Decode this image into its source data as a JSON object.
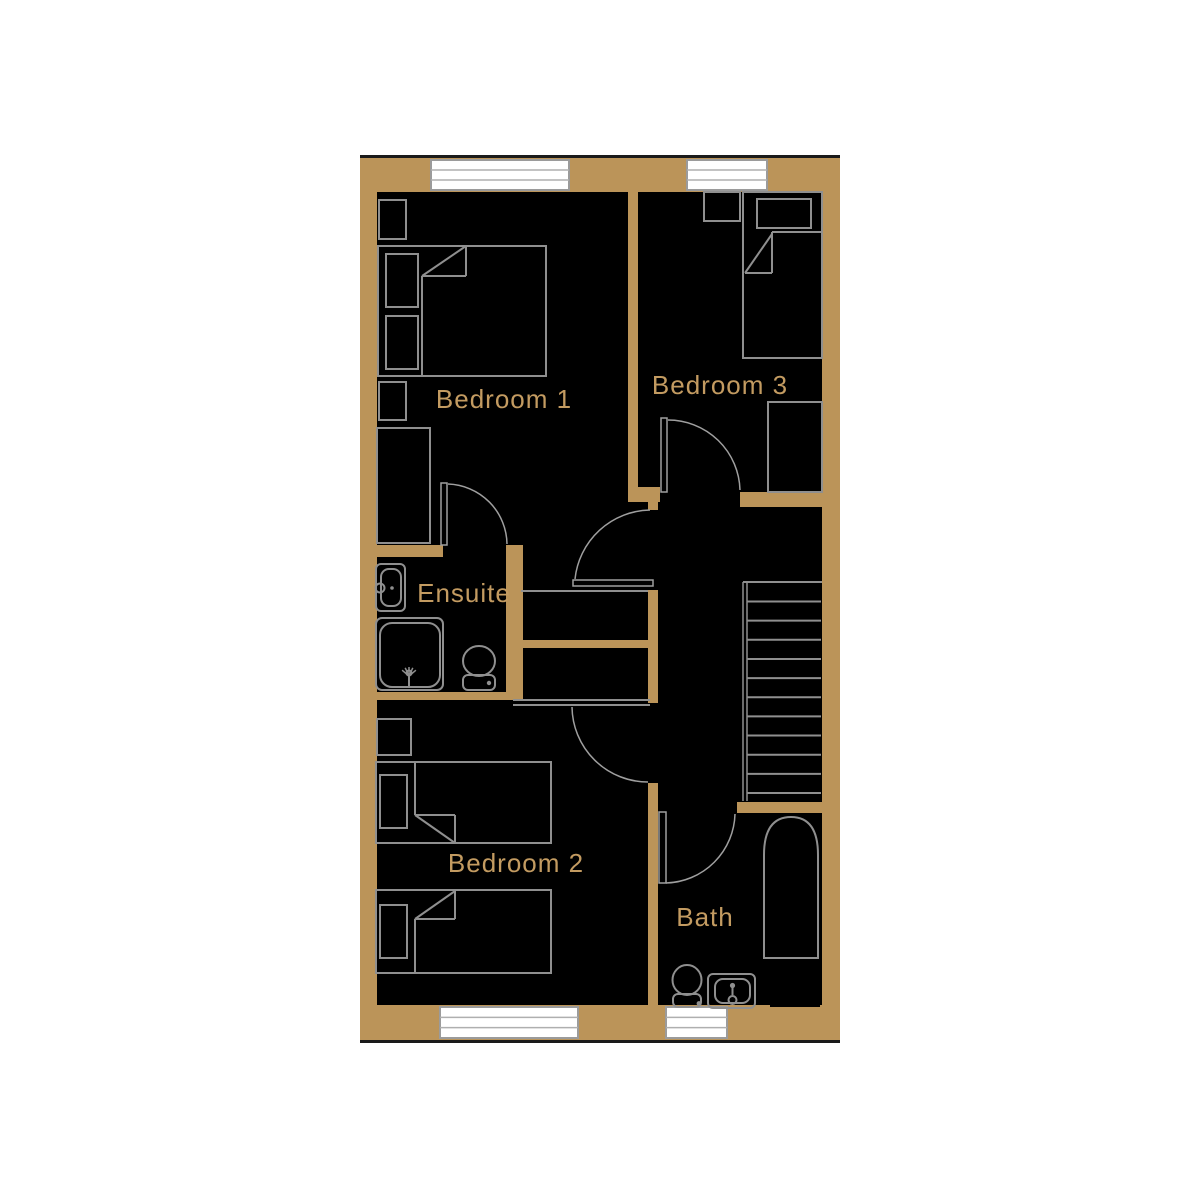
{
  "colors": {
    "background": "#ffffff",
    "floor": "#000000",
    "wall": "#bb9459",
    "label": "#c39b61",
    "furniture": "#8f8f8f",
    "door": "#9f9f9f",
    "window_border": "#9b9b9b",
    "window_slat": "#afafaf",
    "window_fill": "#ffffff",
    "exterior_line": "#1a1a1a"
  },
  "rooms": [
    {
      "id": "bedroom1",
      "label": "Bedroom 1",
      "x": 504,
      "y": 408
    },
    {
      "id": "bedroom3",
      "label": "Bedroom 3",
      "x": 720,
      "y": 394
    },
    {
      "id": "ensuite",
      "label": "Ensuite",
      "x": 464,
      "y": 602
    },
    {
      "id": "bedroom2",
      "label": "Bedroom 2",
      "x": 516,
      "y": 872
    },
    {
      "id": "bath",
      "label": "Bath",
      "x": 705,
      "y": 926
    }
  ],
  "geometry": {
    "plan_rect": [
      360,
      155,
      480,
      888
    ],
    "exterior_lines": [
      [
        360,
        156.5,
        840,
        156.5
      ],
      [
        360,
        1041.5,
        840,
        1041.5
      ]
    ],
    "walls": [
      {
        "n": "outer-wall-top",
        "r": [
          360,
          157,
          480,
          35
        ]
      },
      {
        "n": "outer-wall-left",
        "r": [
          360,
          157,
          17,
          883
        ]
      },
      {
        "n": "outer-wall-right",
        "r": [
          822,
          157,
          18,
          883
        ]
      },
      {
        "n": "outer-wall-bottom",
        "r": [
          360,
          1005,
          480,
          35
        ]
      },
      {
        "n": "wall-bed1-bed3-divider",
        "r": [
          628,
          161,
          10,
          331
        ]
      },
      {
        "n": "wall-divider-foot",
        "r": [
          628,
          487,
          32,
          15
        ]
      },
      {
        "n": "wall-divider-stub",
        "r": [
          648,
          502,
          10,
          8
        ]
      },
      {
        "n": "wall-bed3-bottom",
        "r": [
          740,
          492,
          82,
          15
        ]
      },
      {
        "n": "wall-ensuite-top",
        "r": [
          360,
          545,
          83,
          12
        ]
      },
      {
        "n": "wall-ensuite-right",
        "r": [
          506,
          545,
          17,
          155
        ]
      },
      {
        "n": "wall-ensuite-bottom",
        "r": [
          360,
          692,
          146,
          8
        ]
      },
      {
        "n": "wall-cupboard-mid",
        "r": [
          511,
          640,
          144,
          8
        ]
      },
      {
        "n": "wall-landing-west",
        "r": [
          648,
          590,
          10,
          113
        ]
      },
      {
        "n": "wall-bed2-bath-divider",
        "r": [
          648,
          783,
          10,
          222
        ]
      },
      {
        "n": "wall-bath-top",
        "r": [
          737,
          802,
          103,
          11
        ]
      }
    ],
    "windows": [
      {
        "n": "window-top-bedroom1",
        "r": [
          431,
          160,
          138,
          30
        ]
      },
      {
        "n": "window-top-bedroom3",
        "r": [
          687,
          160,
          80,
          30
        ]
      },
      {
        "n": "window-bottom-bedroom2",
        "r": [
          440,
          1007,
          138,
          31
        ]
      },
      {
        "n": "window-bottom-bath",
        "r": [
          666,
          1007,
          61,
          31
        ]
      }
    ],
    "thin_lines": [
      {
        "n": "cupboard-front-line",
        "l": [
          521,
          591,
          648,
          591
        ]
      },
      {
        "n": "bedroom2-door-head-line",
        "l": [
          513,
          700,
          650,
          700
        ]
      },
      {
        "n": "bedroom2-door-head-line",
        "l": [
          513,
          705,
          650,
          705
        ]
      }
    ],
    "stairs": {
      "top_line": [
        743,
        582,
        822,
        582
      ],
      "left_lines_x": [
        743,
        747
      ],
      "y_top": 582,
      "y_bottom": 801,
      "tread_x": [
        747,
        821
      ],
      "tread_y0": 601.5,
      "tread_step": 19.15,
      "tread_count": 11
    },
    "furniture_rects": [
      {
        "n": "bedroom1-bedside-top",
        "r": [
          379,
          200,
          27,
          39
        ]
      },
      {
        "n": "bedroom1-double-bed",
        "r": [
          378,
          246,
          168,
          130
        ]
      },
      {
        "n": "bedroom1-pillow-1",
        "r": [
          386,
          254,
          32,
          53
        ]
      },
      {
        "n": "bedroom1-pillow-2",
        "r": [
          386,
          316,
          32,
          53
        ]
      },
      {
        "n": "bedroom1-bedside-bottom",
        "r": [
          379,
          382,
          27,
          38
        ]
      },
      {
        "n": "bedroom1-wardrobe",
        "r": [
          377,
          428,
          53,
          115
        ]
      },
      {
        "n": "bedroom3-bedside",
        "r": [
          704,
          192,
          36,
          29
        ]
      },
      {
        "n": "bedroom3-single-bed",
        "r": [
          743,
          192,
          79,
          166
        ]
      },
      {
        "n": "bedroom3-pillow",
        "r": [
          757,
          199,
          54,
          29
        ]
      },
      {
        "n": "bedroom3-wardrobe",
        "r": [
          768,
          402,
          54,
          90
        ]
      },
      {
        "n": "bedroom2-cabinet",
        "r": [
          377,
          719,
          34,
          36
        ]
      },
      {
        "n": "bedroom2-bed-a",
        "r": [
          376,
          762,
          175,
          81
        ]
      },
      {
        "n": "bedroom2-pillow-a",
        "r": [
          380,
          775,
          27,
          53
        ]
      },
      {
        "n": "bedroom2-bed-b",
        "r": [
          376,
          890,
          175,
          83
        ]
      },
      {
        "n": "bedroom2-pillow-b",
        "r": [
          380,
          905,
          27,
          53
        ]
      }
    ],
    "furniture_lines": [
      {
        "n": "bedroom1-duvet-edge",
        "l": [
          422,
          276,
          422,
          376
        ]
      },
      {
        "n": "bedroom1-duvet-fold",
        "l": [
          422,
          276,
          466,
          246
        ]
      },
      {
        "n": "bedroom1-duvet-fold",
        "l": [
          466,
          246,
          466,
          276
        ]
      },
      {
        "n": "bedroom1-duvet-fold",
        "l": [
          422,
          276,
          466,
          276
        ]
      },
      {
        "n": "bedroom3-duvet-edge",
        "l": [
          772,
          232,
          822,
          232
        ]
      },
      {
        "n": "bedroom3-duvet-fold",
        "l": [
          745,
          273,
          772,
          234
        ]
      },
      {
        "n": "bedroom3-duvet-fold",
        "l": [
          772,
          232,
          772,
          273
        ]
      },
      {
        "n": "bedroom3-duvet-fold",
        "l": [
          745,
          273,
          772,
          273
        ]
      },
      {
        "n": "bedroom2-bed-a-duvet-edge",
        "l": [
          415,
          762,
          415,
          815
        ]
      },
      {
        "n": "bedroom2-bed-a-fold",
        "l": [
          415,
          815,
          455,
          843
        ]
      },
      {
        "n": "bedroom2-bed-a-fold",
        "l": [
          415,
          815,
          455,
          815
        ]
      },
      {
        "n": "bedroom2-bed-a-fold",
        "l": [
          455,
          815,
          455,
          843
        ]
      },
      {
        "n": "bedroom2-bed-b-duvet-edge",
        "l": [
          415,
          919,
          415,
          973
        ]
      },
      {
        "n": "bedroom2-bed-b-fold",
        "l": [
          415,
          919,
          455,
          891
        ]
      },
      {
        "n": "bedroom2-bed-b-fold",
        "l": [
          415,
          919,
          455,
          919
        ]
      },
      {
        "n": "bedroom2-bed-b-fold",
        "l": [
          455,
          891,
          455,
          919
        ]
      }
    ],
    "rounded_rects": [
      {
        "n": "ensuite-shower-tray",
        "r": [
          376,
          618,
          67,
          72
        ],
        "rx": 6
      },
      {
        "n": "ensuite-shower-tray-inner",
        "r": [
          380,
          623,
          60,
          64
        ],
        "rx": 12
      },
      {
        "n": "ensuite-basin",
        "r": [
          376,
          564,
          29,
          47
        ],
        "rx": 5
      },
      {
        "n": "ensuite-basin-inner",
        "r": [
          381,
          569,
          20,
          37
        ],
        "rx": 8
      },
      {
        "n": "ensuite-toilet-cistern",
        "r": [
          463,
          675,
          32,
          15
        ],
        "rx": 5
      },
      {
        "n": "bath-sink",
        "r": [
          708,
          974,
          47,
          34
        ],
        "rx": 5
      },
      {
        "n": "bath-sink-inner",
        "r": [
          715,
          979,
          35,
          24
        ],
        "rx": 8
      },
      {
        "n": "bath-toilet-cistern",
        "r": [
          673,
          994,
          28,
          13
        ],
        "rx": 5
      }
    ],
    "ellipses": [
      {
        "n": "ensuite-toilet-bowl",
        "e": [
          479,
          661,
          16,
          15
        ]
      },
      {
        "n": "bath-toilet-bowl",
        "e": [
          687,
          980,
          14.5,
          15
        ]
      }
    ],
    "circles": [
      {
        "n": "ensuite-basin-faucet",
        "c": [
          380,
          588,
          4.5
        ],
        "fill": false
      },
      {
        "n": "bath-sink-drain",
        "c": [
          732.5,
          1000,
          4
        ],
        "fill": false
      },
      {
        "n": "shower-head",
        "c": [
          409,
          673,
          2.5
        ],
        "fill": false
      }
    ],
    "dots": [
      {
        "n": "ensuite-basin-tap-dot",
        "c": [
          392,
          588,
          1.8
        ]
      },
      {
        "n": "ensuite-cistern-button",
        "c": [
          489,
          683,
          2.2
        ]
      },
      {
        "n": "bath-sink-faucet-dot",
        "c": [
          732.5,
          985.5,
          2.6
        ]
      },
      {
        "n": "bath-cistern-button",
        "c": [
          699,
          1003.5,
          2.4
        ]
      }
    ],
    "stem_lines": [
      {
        "n": "shower-head-stem",
        "l": [
          409,
          676,
          409,
          687
        ]
      },
      {
        "n": "bath-sink-faucet-stem",
        "l": [
          732.5,
          988,
          732.5,
          995
        ]
      }
    ],
    "shower_fan": {
      "cx": 409,
      "cy": 676,
      "len": 9,
      "angles": [
        -50,
        -25,
        0,
        25,
        50
      ]
    },
    "tub": {
      "n": "bath-tub",
      "x": 762,
      "y": 815,
      "w": 58,
      "h": 145
    },
    "black_rects": [
      {
        "n": "bath-corner-recess",
        "r": [
          770,
          977,
          50,
          30
        ]
      }
    ],
    "door_leaves": [
      {
        "n": "ensuite-door-leaf",
        "r": [
          441,
          483,
          6,
          62
        ]
      },
      {
        "n": "bedroom1-door-leaf",
        "r": [
          573,
          580,
          80,
          6
        ]
      },
      {
        "n": "bedroom3-door-leaf",
        "r": [
          661,
          418,
          6,
          74
        ]
      },
      {
        "n": "bath-door-leaf",
        "r": [
          659,
          812,
          7,
          71
        ]
      }
    ],
    "door_arcs": [
      {
        "n": "ensuite-door-swing",
        "d": "M448,484 A61,61 0 0 1 507,544"
      },
      {
        "n": "bedroom1-door-swing",
        "d": "M575,579 A77,77 0 0 1 650,510"
      },
      {
        "n": "bedroom3-door-swing",
        "d": "M668,420 A72,72 0 0 1 740,490"
      },
      {
        "n": "bedroom2-door-swing",
        "d": "M572,707 A76,76 0 0 0 648,782"
      },
      {
        "n": "bath-door-swing",
        "d": "M666,883 A71,71 0 0 0 735,814"
      }
    ]
  }
}
